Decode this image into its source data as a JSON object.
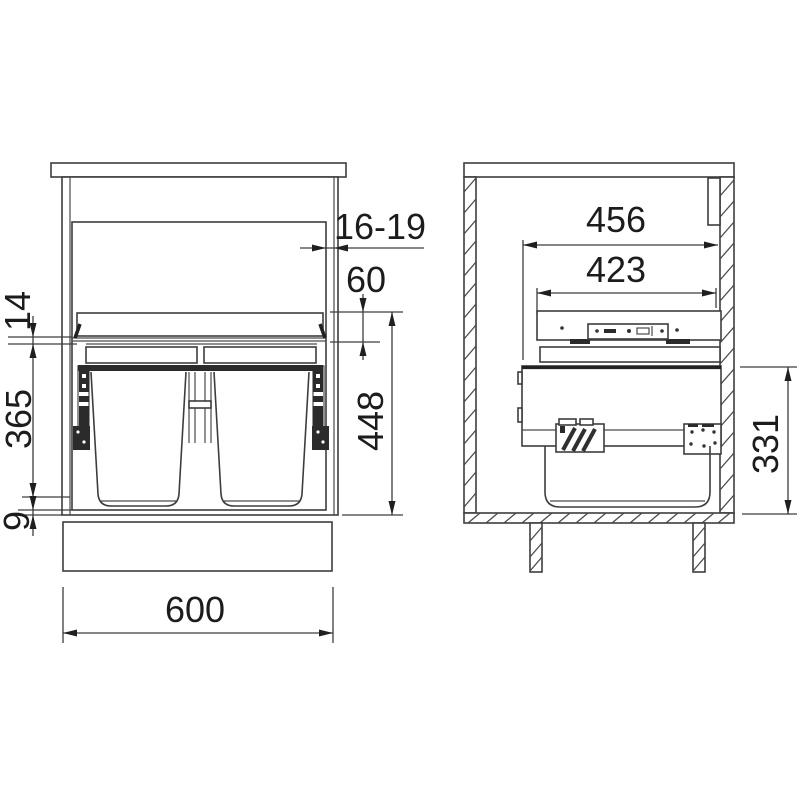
{
  "drawing": {
    "type": "cabinet waste-sorter installation drawing, front and side section views"
  },
  "front_view": {
    "dim_door_reveal": "16-19",
    "dim_lid_height": "60",
    "dim_lid_frame": "14",
    "dim_bin_height": "365",
    "dim_bottom_gap": "9",
    "dim_inner_height": "448",
    "dim_width": "600"
  },
  "side_view": {
    "dim_depth": "456",
    "dim_frame_depth": "423",
    "dim_unit_height": "331"
  }
}
